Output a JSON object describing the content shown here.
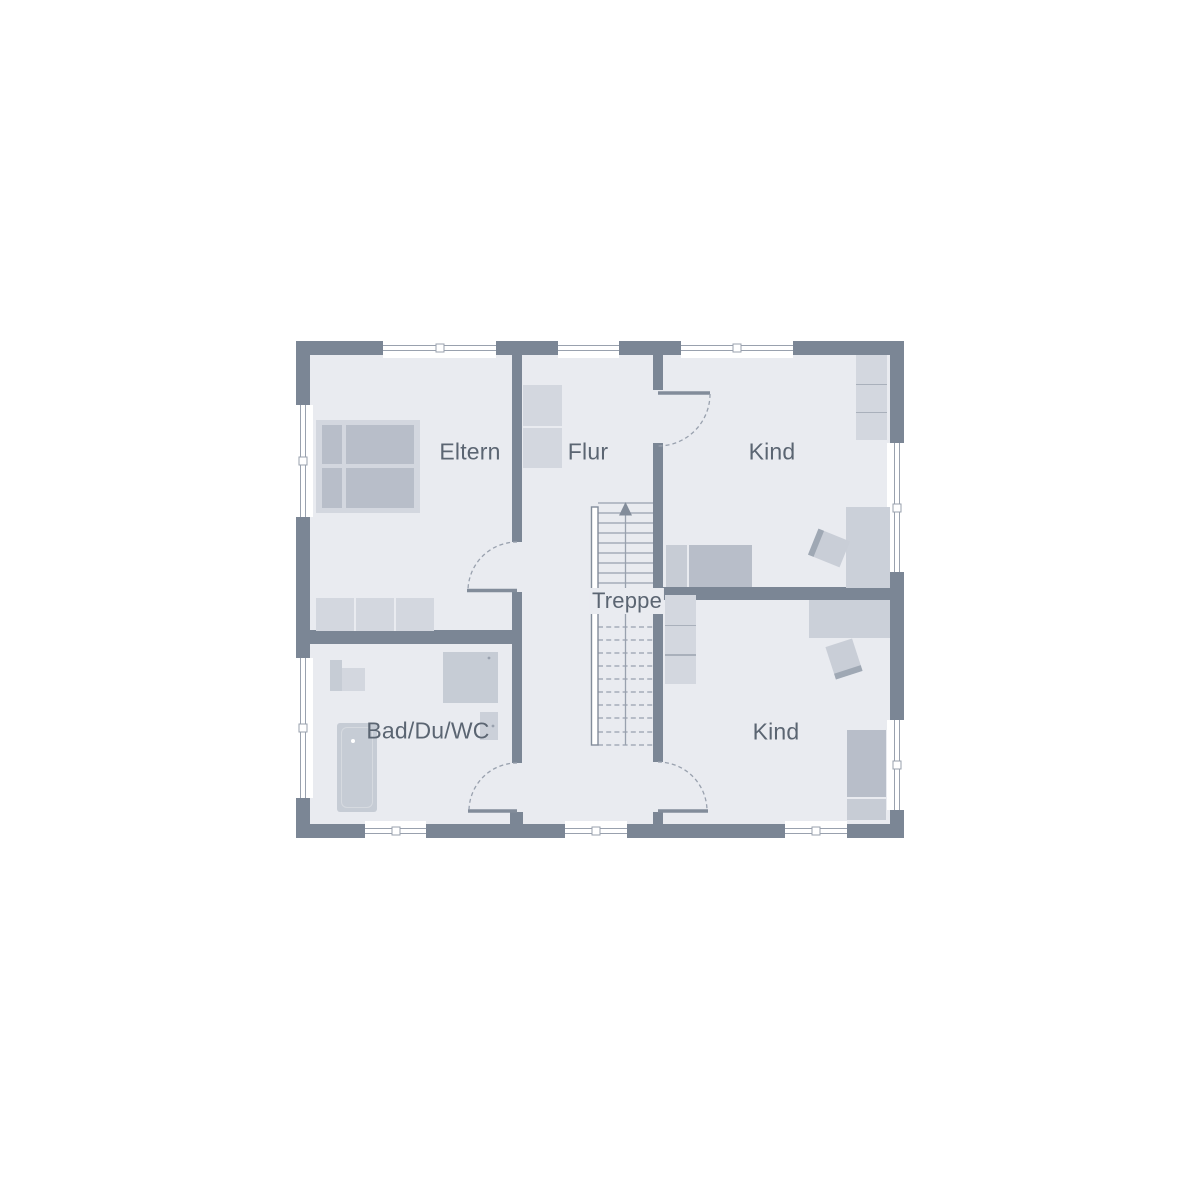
{
  "rooms": {
    "eltern": {
      "label": "Eltern"
    },
    "flur": {
      "label": "Flur"
    },
    "kind_top": {
      "label": "Kind"
    },
    "kind_bottom": {
      "label": "Kind"
    },
    "bad": {
      "label": "Bad/Du/WC"
    },
    "treppe": {
      "label": "Treppe"
    }
  },
  "furniture": {
    "eltern": [
      "double-bed",
      "wardrobe"
    ],
    "flur": [
      "wardrobe"
    ],
    "kind_top": [
      "wardrobe",
      "desk",
      "chair",
      "single-bed"
    ],
    "kind_bottom": [
      "wardrobe",
      "desk",
      "chair",
      "single-bed"
    ],
    "bad": [
      "washbasin",
      "shower",
      "wc",
      "bathtub"
    ]
  },
  "stairs": {
    "direction": "up",
    "solid_treads": 9,
    "dashed_treads": 10
  },
  "counts": {
    "windows": 10,
    "doors": 4
  },
  "colors": {
    "wall": "#7b8695",
    "floor": "#e9ebf0",
    "line": "#99a1ae",
    "leaf": "#828c9a",
    "label_text": "#5b6572",
    "furn_light": "#d3d7df",
    "furn_mid": "#c6ccd5",
    "furn_dark": "#b8bec9",
    "pillow": "#c7ccd5",
    "desk": "#cbd0d9",
    "chair": "#c9ced7",
    "chair_edge": "#9fa8b4",
    "divider": "#a9b0bb"
  }
}
